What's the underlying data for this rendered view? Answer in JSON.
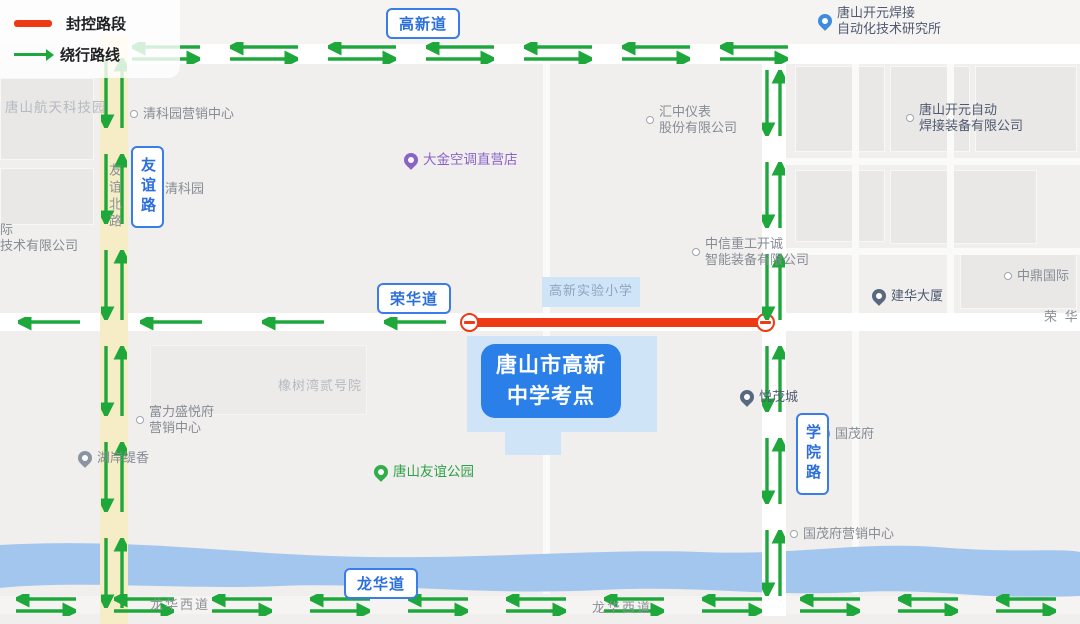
{
  "legend": {
    "items": [
      {
        "id": "closed-road",
        "label": "封控路段"
      },
      {
        "id": "detour-route",
        "label": "绕行路线"
      }
    ]
  },
  "badges": {
    "gaoxindao": "高新道",
    "ronghuadao": "荣华道",
    "longhuadao": "龙华道",
    "youyilu": "友谊路",
    "xueyuanlu": "学院路"
  },
  "exam_site": {
    "line1": "唐山市高新",
    "line2": "中学考点"
  },
  "road_names": {
    "youyi_north": "友谊北路",
    "ronghua_east": "荣 华",
    "longhuaxi_west": "龙华西道",
    "longhuaxi_east": "龙华西道"
  },
  "pois": [
    {
      "id": "tangshan-aerospace-park",
      "lines": [
        "唐山航天科技园"
      ]
    },
    {
      "id": "qingkeyuan-marketing",
      "lines": [
        "清科园营销中心"
      ]
    },
    {
      "id": "qingkeyuan",
      "lines": [
        "清科园"
      ]
    },
    {
      "id": "daikin-ac-store",
      "lines": [
        "大金空调直营店"
      ]
    },
    {
      "id": "huizhong-instrument",
      "lines": [
        "汇中仪表",
        "股份有限公司"
      ]
    },
    {
      "id": "kaiyuan-welding-institute",
      "lines": [
        "唐山开元焊接",
        "自动化技术研究所"
      ]
    },
    {
      "id": "kaiyuan-welding-equipment",
      "lines": [
        "唐山开元自动",
        "焊接装备有限公司"
      ]
    },
    {
      "id": "citic-hic-kaicheng",
      "lines": [
        "中信重工开诚",
        "智能装备有限公司"
      ]
    },
    {
      "id": "gaoxin-experimental-primary",
      "lines": [
        "高新实验小学"
      ]
    },
    {
      "id": "jianhua-tower",
      "lines": [
        "建华大厦"
      ]
    },
    {
      "id": "zhongding-international",
      "lines": [
        "中鼎国际"
      ]
    },
    {
      "id": "xiangshuwan-no2",
      "lines": [
        "橡树湾贰号院"
      ]
    },
    {
      "id": "fuli-shengyuefu-marketing",
      "lines": [
        "富力盛悦府",
        "营销中心"
      ]
    },
    {
      "id": "huan-tixiang",
      "lines": [
        "湖岸缇香"
      ]
    },
    {
      "id": "tangshan-friendship-park",
      "lines": [
        "唐山友谊公园"
      ]
    },
    {
      "id": "yuemao-city",
      "lines": [
        "悦茂城"
      ]
    },
    {
      "id": "guomaofu",
      "lines": [
        "国茂府"
      ]
    },
    {
      "id": "guomaofu-marketing",
      "lines": [
        "国茂府营销中心"
      ]
    },
    {
      "id": "left-edge-partial",
      "lines": [
        "际",
        "技术有限公司"
      ]
    }
  ],
  "colors": {
    "closed_road": "#ee3914",
    "detour_green": "#1ea83b",
    "badge_blue": "#2b6fdd",
    "exam_badge_bg": "#2a80e8",
    "river": "#a3c6ef",
    "main_road_yellow": "#f6ecc5"
  }
}
